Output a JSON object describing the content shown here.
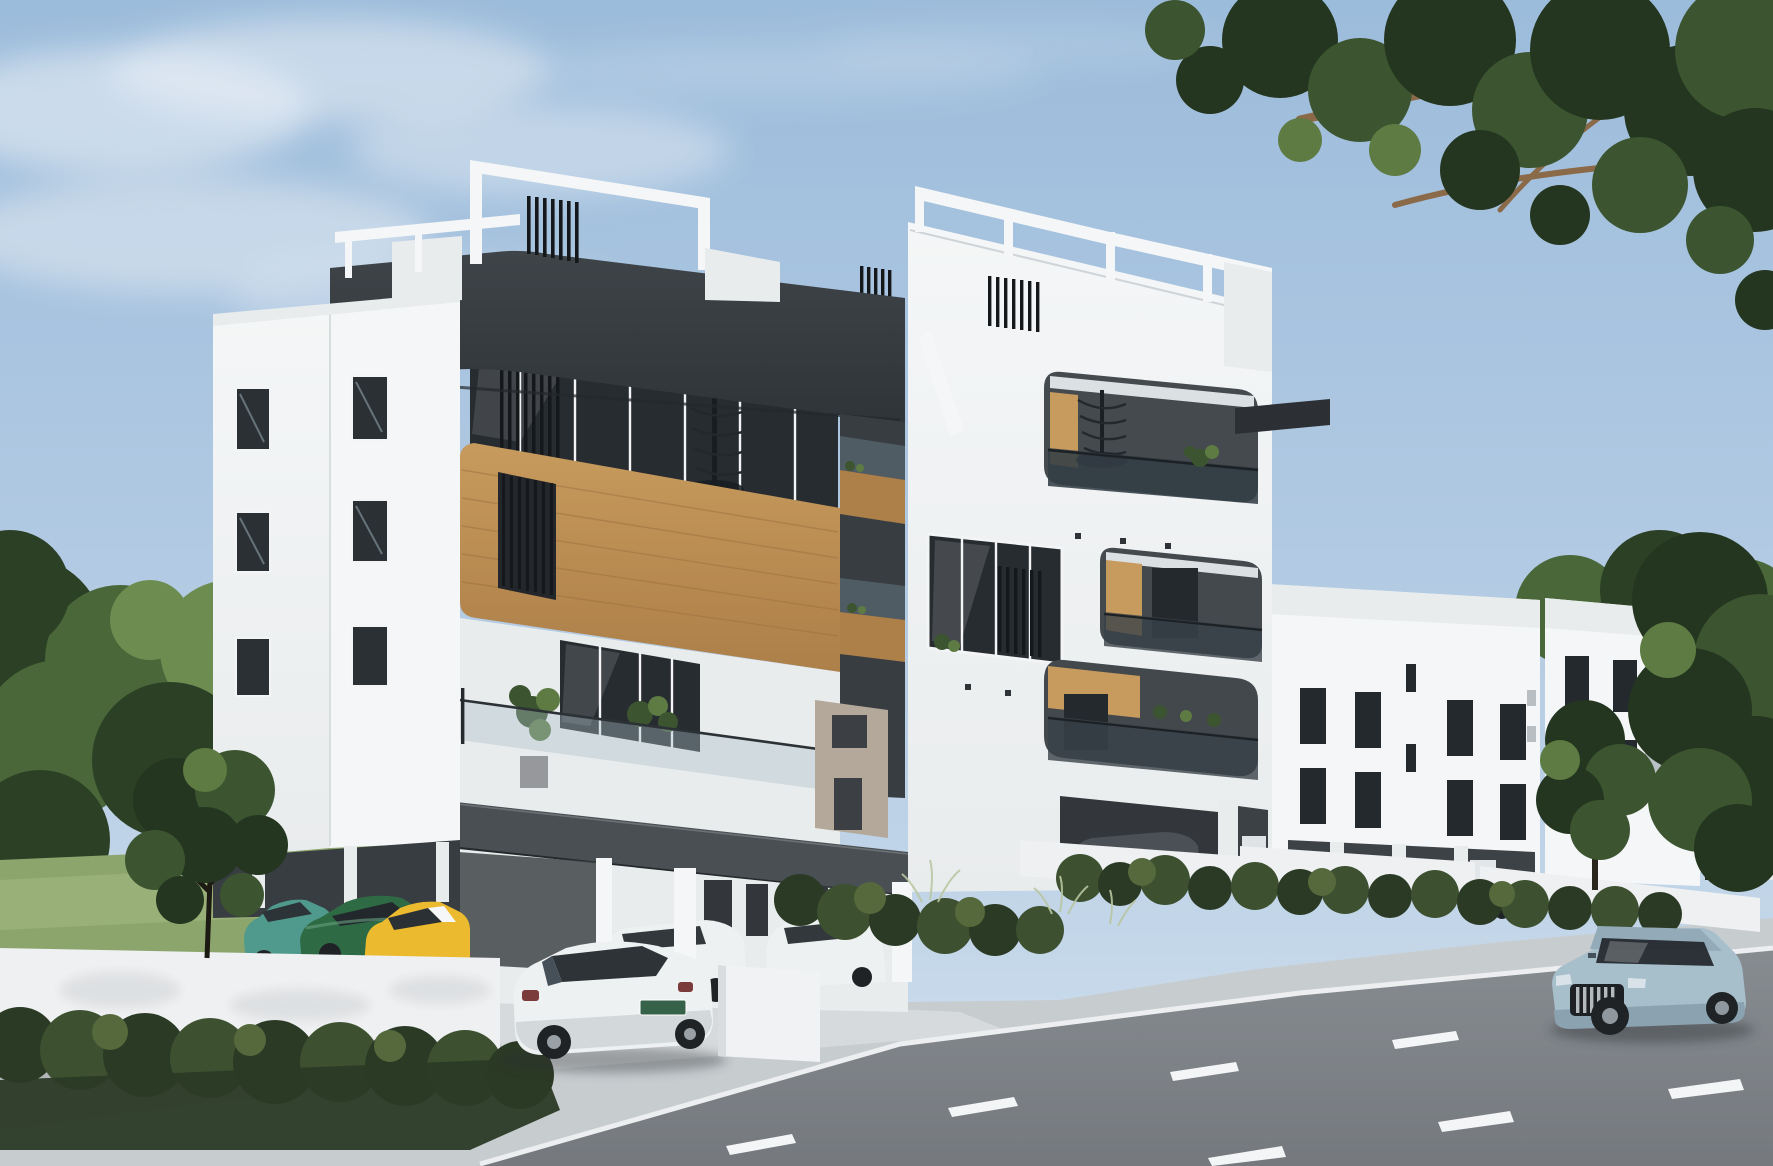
{
  "scene": {
    "type": "architectural-render",
    "setting": "modern-apartment-building-exterior-daytime",
    "objects": [
      "sky",
      "clouds",
      "overhanging-tree-branches",
      "background-trees",
      "lawn",
      "main-apartment-building",
      "dark-frame-band",
      "rooftop-pergolas",
      "pergola-slat-screens",
      "spiral-staircase",
      "wood-clad-balcony",
      "glass-balustrades",
      "balcony-plants",
      "neighbor-building-left-wing",
      "neighbor-white-building-1",
      "neighbor-white-building-2",
      "neighbor-white-building-3",
      "perimeter-wall",
      "front-hedge",
      "ornamental-bushes",
      "sidewalk",
      "driveway-apron",
      "asphalt-road",
      "lane-markings",
      "kerb",
      "teal-hatchback",
      "green-coupe",
      "yellow-hatchback",
      "white-sedan",
      "white-van",
      "cars-under-building",
      "dark-parked-car",
      "silver-suv"
    ]
  },
  "colors": {
    "sky_top": "#9cbcdb",
    "sky_mid": "#b5cce4",
    "sky_bottom": "#cfdfed",
    "cloud": "#eff3f7",
    "canopy_dark": "#24361f",
    "canopy_mid": "#3c5530",
    "canopy_light": "#5d7b42",
    "branch": "#8a6a48",
    "treeline_dark": "#2c4026",
    "treeline_mid": "#4a6739",
    "treeline_light": "#6d8c50",
    "grass": "#8ba56c",
    "grass_light": "#9fb77e",
    "white_lit": "#f4f6f7",
    "white_soft": "#e9eced",
    "white_shade": "#dbe0e3",
    "white_dim": "#cfd5d9",
    "charcoal": "#3f4449",
    "charcoal_dark": "#2f3438",
    "charcoal_side": "#383d42",
    "slab": "#4a4f54",
    "wood": "#c79a5d",
    "wood_dark": "#ad7f49",
    "wood_line": "#9c7040",
    "glass_dark": "#272c31",
    "glass_tint": "#5f6e79",
    "glass_light": "#a9bcc8",
    "window": "#24292e",
    "beige": "#b3a89a",
    "hedge_dark": "#2b3a25",
    "hedge_mid": "#3d5131",
    "hedge_light": "#55693c",
    "wall_white": "#eef0f2",
    "sidewalk": "#c7cccf",
    "apron": "#d8dbdd",
    "kerb": "#eceeef",
    "road": "#878c91",
    "road_dark": "#75797e",
    "marking": "#f3f5f6",
    "car_teal": "#4f9a8c",
    "car_green": "#2e6b45",
    "car_yellow": "#ecba2e",
    "car_white": "#eef1f2",
    "car_gray": "#4a5055",
    "suv_body": "#a7becb",
    "suv_dark": "#8ba2b0",
    "tyre": "#1f2326",
    "shadow": "#2b2f33",
    "taillight": "#7c3b3b",
    "plate": "#2d5b40"
  }
}
